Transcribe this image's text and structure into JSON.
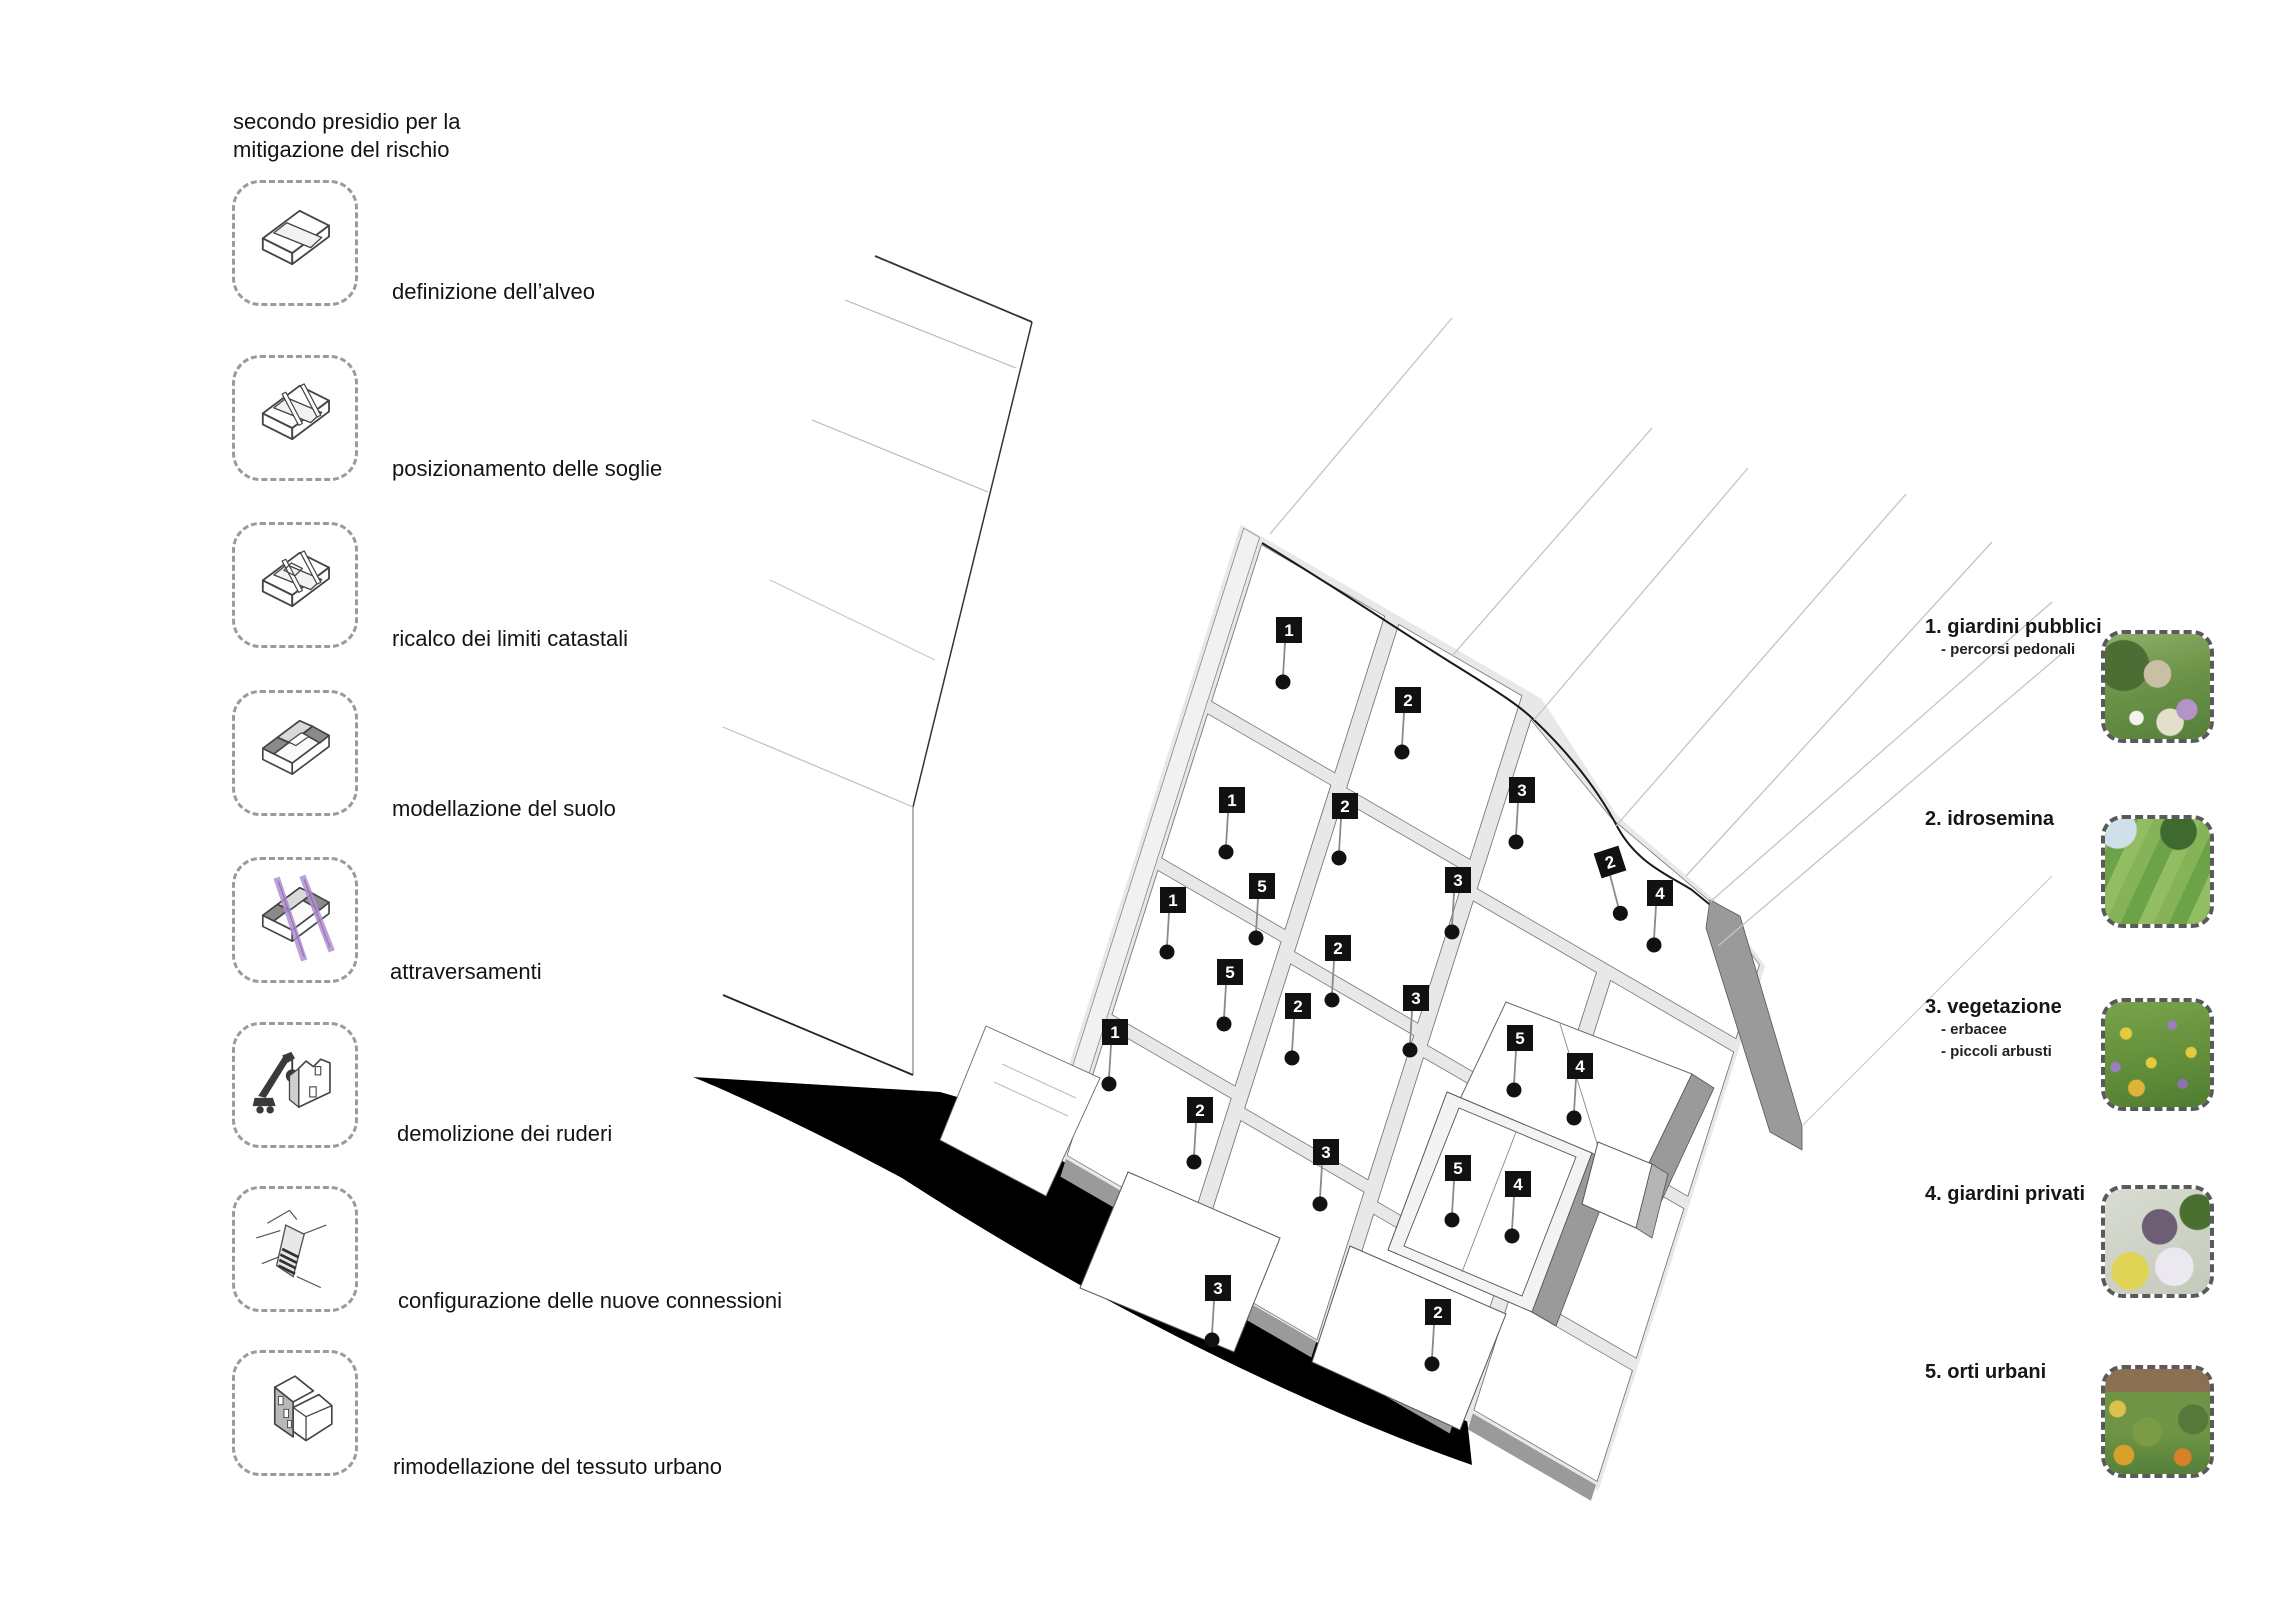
{
  "left_panel": {
    "title_line1": "secondo presidio per la",
    "title_line2": "mitigazione del rischio",
    "steps": [
      {
        "icon": "channel-block-icon",
        "label": "definizione dell’alveo"
      },
      {
        "icon": "channel-sills-icon",
        "label": "posizionamento delle soglie"
      },
      {
        "icon": "cadastral-limits-icon",
        "label": "ricalco dei limiti catastali"
      },
      {
        "icon": "soil-modelling-icon",
        "label": "modellazione del suolo"
      },
      {
        "icon": "crossings-icon",
        "label": "attraversamenti"
      },
      {
        "icon": "demolition-crane-icon",
        "label": "demolizione dei ruderi"
      },
      {
        "icon": "new-connections-icon",
        "label": "configurazione delle nuove connessioni"
      },
      {
        "icon": "urban-fabric-icon",
        "label": "rimodellazione del tessuto urbano"
      }
    ]
  },
  "legend": {
    "items": [
      {
        "number": "1.",
        "label": "giardini pubblici",
        "sublabels": [
          "- percorsi pedonali"
        ],
        "photo": "public-garden-photo"
      },
      {
        "number": "2.",
        "label": "idrosemina",
        "sublabels": [],
        "photo": "hydroseeding-photo"
      },
      {
        "number": "3.",
        "label": "vegetazione",
        "sublabels": [
          "- erbacee",
          "- piccoli arbusti"
        ],
        "photo": "wildflower-meadow-photo"
      },
      {
        "number": "4.",
        "label": "giardini privati",
        "sublabels": [],
        "photo": "private-garden-photo"
      },
      {
        "number": "5.",
        "label": "orti urbani",
        "sublabels": [],
        "photo": "urban-vegetable-garden-photo"
      }
    ]
  },
  "diagram": {
    "description": "axonometric terraced hillside plan with numbered intervention tags",
    "colors": {
      "base_black": "#000000",
      "wall_light": "#e8e8e8",
      "wall_dark": "#9a9a9a",
      "outline": "#555555",
      "tag_background": "#111111",
      "accent_purple": "#b18fd0"
    },
    "tags": [
      {
        "n": "1",
        "x": 1289,
        "y": 630
      },
      {
        "n": "2",
        "x": 1408,
        "y": 700
      },
      {
        "n": "3",
        "x": 1522,
        "y": 790
      },
      {
        "n": "1",
        "x": 1232,
        "y": 800
      },
      {
        "n": "2",
        "x": 1345,
        "y": 806
      },
      {
        "n": "3",
        "x": 1458,
        "y": 880
      },
      {
        "n": "2",
        "x": 1610,
        "y": 862,
        "rot": -18
      },
      {
        "n": "4",
        "x": 1660,
        "y": 893
      },
      {
        "n": "1",
        "x": 1173,
        "y": 900
      },
      {
        "n": "5",
        "x": 1262,
        "y": 886
      },
      {
        "n": "2",
        "x": 1338,
        "y": 948
      },
      {
        "n": "5",
        "x": 1230,
        "y": 972
      },
      {
        "n": "2",
        "x": 1298,
        "y": 1006
      },
      {
        "n": "3",
        "x": 1416,
        "y": 998
      },
      {
        "n": "5",
        "x": 1520,
        "y": 1038
      },
      {
        "n": "4",
        "x": 1580,
        "y": 1066
      },
      {
        "n": "1",
        "x": 1115,
        "y": 1032
      },
      {
        "n": "2",
        "x": 1200,
        "y": 1110
      },
      {
        "n": "3",
        "x": 1326,
        "y": 1152
      },
      {
        "n": "5",
        "x": 1458,
        "y": 1168
      },
      {
        "n": "4",
        "x": 1518,
        "y": 1184
      },
      {
        "n": "3",
        "x": 1218,
        "y": 1288
      },
      {
        "n": "2",
        "x": 1438,
        "y": 1312
      }
    ]
  }
}
